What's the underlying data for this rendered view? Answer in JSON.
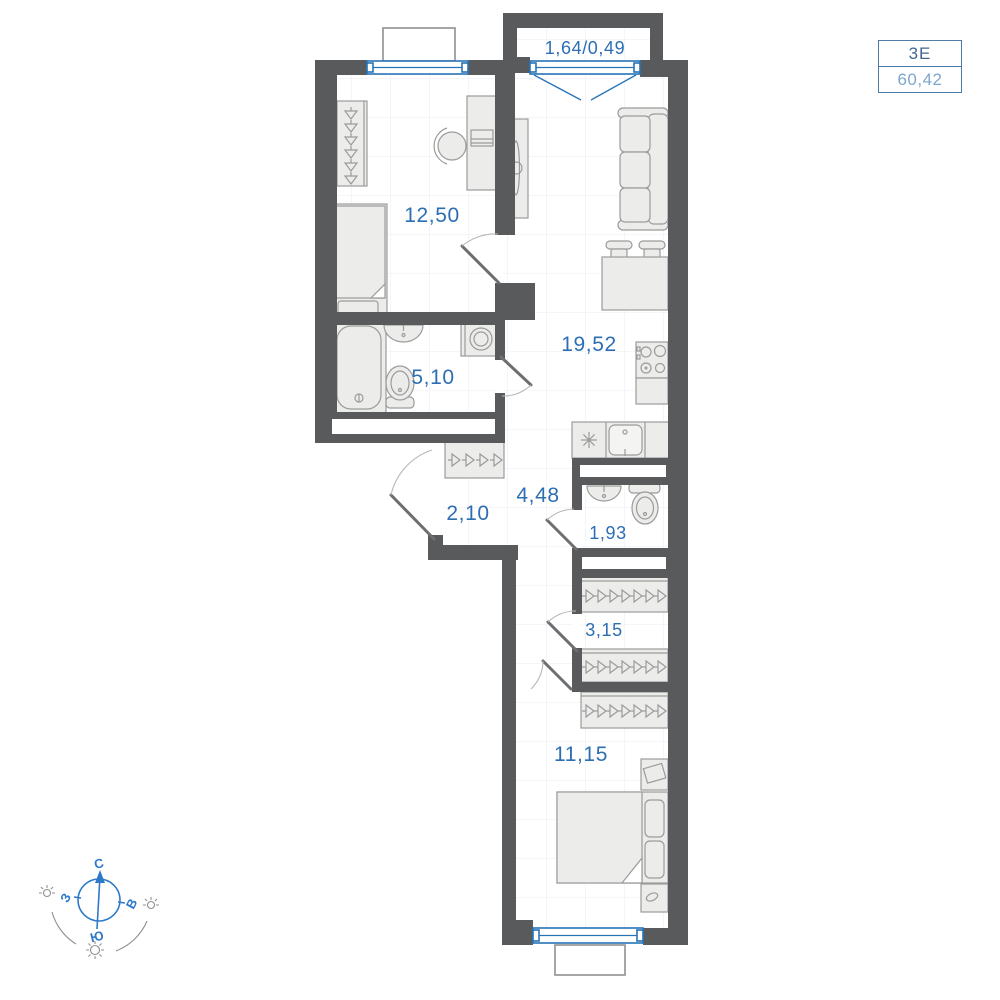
{
  "title_box": {
    "plan_type": "3Е",
    "total_area": "60,42"
  },
  "rooms": [
    {
      "id": "balcony-top",
      "area_label": "1,64/0,49"
    },
    {
      "id": "bedroom-1",
      "area_label": "12,50"
    },
    {
      "id": "kitchen-living",
      "area_label": "19,52"
    },
    {
      "id": "bathroom",
      "area_label": "5,10"
    },
    {
      "id": "hall",
      "area_label": "2,10"
    },
    {
      "id": "corridor",
      "area_label": "4,48"
    },
    {
      "id": "wc",
      "area_label": "1,93"
    },
    {
      "id": "closet",
      "area_label": "3,15"
    },
    {
      "id": "bedroom-2",
      "area_label": "11,15"
    }
  ],
  "compass": {
    "north": "С",
    "south": "Ю",
    "west": "З",
    "east": "В"
  },
  "colors": {
    "wall": "#595a5c",
    "label_blue": "#2d6eb3",
    "window_blue": "#2673b6",
    "furniture_fill": "#ececeb",
    "furniture_stroke": "#9b9b9b",
    "title_dark_blue": "#42688f",
    "title_light_blue": "#7ea7cd",
    "compass_blue": "#2e79c8"
  }
}
